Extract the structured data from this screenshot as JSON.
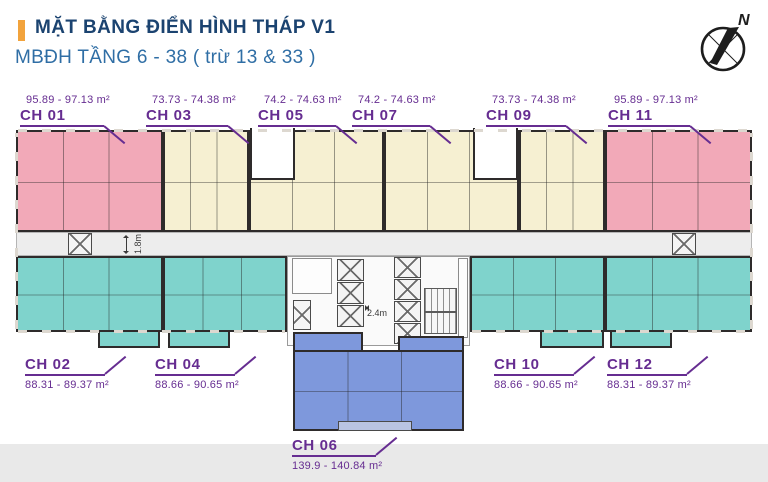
{
  "header": {
    "title": "MẶT BẰNG ĐIỂN HÌNH THÁP V1",
    "subtitle": "MBĐH TẦNG 6 - 38 ( trừ 13 & 33 )"
  },
  "compass": {
    "north_label": "N"
  },
  "plan": {
    "corridor_dim": "1.8m",
    "lobby_dim": "2.4m"
  },
  "units": [
    {
      "id": "CH 01",
      "area": "95.89 - 97.13 m²"
    },
    {
      "id": "CH 03",
      "area": "73.73 - 74.38 m²"
    },
    {
      "id": "CH 05",
      "area": "74.2 - 74.63 m²"
    },
    {
      "id": "CH 07",
      "area": "74.2 - 74.63 m²"
    },
    {
      "id": "CH 09",
      "area": "73.73 - 74.38 m²"
    },
    {
      "id": "CH 11",
      "area": "95.89 - 97.13 m²"
    },
    {
      "id": "CH 02",
      "area": "88.31 - 89.37 m²"
    },
    {
      "id": "CH 04",
      "area": "88.66 - 90.65 m²"
    },
    {
      "id": "CH 10",
      "area": "88.66 - 90.65 m²"
    },
    {
      "id": "CH 12",
      "area": "88.31 - 89.37 m²"
    },
    {
      "id": "CH 06",
      "area": "139.9 - 140.84 m²"
    }
  ],
  "colors": {
    "accent": "#F2A33C",
    "title": "#1B4370",
    "subtitle": "#2F6EA5",
    "label": "#662D91",
    "pink": "#F2A9B8",
    "cream": "#F6F0D2",
    "teal": "#7FD3CC",
    "blue": "#7E98DC",
    "wall": "#2E2B2B",
    "corridor": "#EDEDED",
    "core": "#FAFAFA",
    "band": "#E9E9E9"
  }
}
